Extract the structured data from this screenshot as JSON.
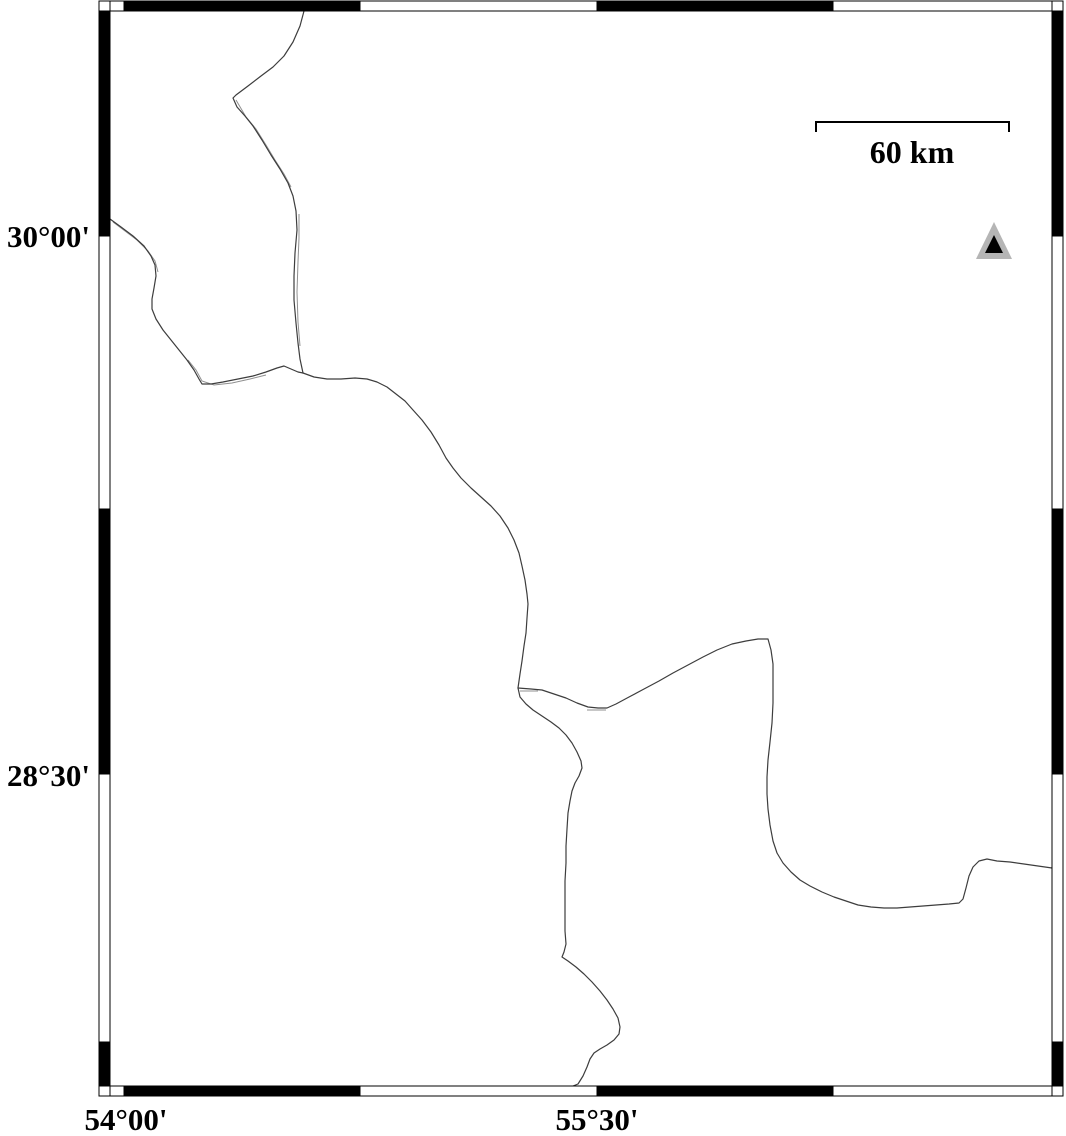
{
  "figure": {
    "width": 1066,
    "height": 1136,
    "background": "#ffffff"
  },
  "colors": {
    "frame_black": "#000000",
    "frame_white": "#ffffff",
    "frame_outline": "#000000",
    "boundary_line": "#3d3d3d",
    "boundary_ghost": "#8f8f8f",
    "marker_outer": "#b5b5b5",
    "marker_inner": "#000000",
    "text": "#000000"
  },
  "frame": {
    "outer": {
      "left": 99,
      "top": 1,
      "right": 1063,
      "bottom": 1096
    },
    "inner": {
      "left": 110,
      "top": 11,
      "right": 1052,
      "bottom": 1086
    },
    "x_boundaries": [
      124,
      360,
      597,
      833
    ],
    "y_boundaries": [
      236,
      509,
      774,
      1042
    ],
    "x_black_segments": [
      [
        124,
        360
      ],
      [
        597,
        833
      ]
    ],
    "y_black_segments": [
      [
        11,
        236
      ],
      [
        509,
        774
      ],
      [
        1042,
        1086
      ]
    ]
  },
  "axes": {
    "left_labels": [
      {
        "text": "30°00'",
        "y": 236,
        "right_x": 90
      },
      {
        "text": "28°30'",
        "y": 775,
        "right_x": 90
      }
    ],
    "bottom_labels": [
      {
        "text": "54°00'",
        "x": 126,
        "y": 1104
      },
      {
        "text": "55°30'",
        "x": 597,
        "y": 1104
      }
    ]
  },
  "scale_bar": {
    "label": "60 km",
    "x1": 816,
    "x2": 1009,
    "y": 122,
    "tick_drop": 10,
    "label_x": 912,
    "label_y": 136
  },
  "marker": {
    "type": "triangle",
    "outer_points": "994,222 976,259 1012,259",
    "inner_points": "994,235 985,253 1003,253"
  },
  "boundaries": {
    "stroke_width": 1.2,
    "lines": {
      "north": [
        [
          304,
          11
        ],
        [
          300,
          26
        ],
        [
          293,
          42
        ],
        [
          284,
          56
        ],
        [
          273,
          67
        ],
        [
          261,
          76
        ],
        [
          248,
          86
        ],
        [
          236,
          95
        ],
        [
          233,
          98
        ],
        [
          237,
          107
        ],
        [
          245,
          116
        ],
        [
          253,
          126
        ],
        [
          262,
          140
        ],
        [
          271,
          155
        ],
        [
          280,
          169
        ],
        [
          288,
          183
        ],
        [
          293,
          196
        ],
        [
          296,
          211
        ],
        [
          297,
          230
        ],
        [
          295,
          253
        ],
        [
          294,
          276
        ],
        [
          294,
          300
        ],
        [
          296,
          323
        ],
        [
          298,
          343
        ],
        [
          300,
          359
        ],
        [
          303,
          373
        ]
      ],
      "west": [
        [
          110,
          219
        ],
        [
          121,
          227
        ],
        [
          133,
          236
        ],
        [
          144,
          246
        ],
        [
          151,
          256
        ],
        [
          155,
          265
        ],
        [
          156,
          276
        ],
        [
          154,
          288
        ],
        [
          152,
          299
        ],
        [
          152,
          309
        ],
        [
          156,
          319
        ],
        [
          163,
          330
        ],
        [
          171,
          340
        ],
        [
          179,
          350
        ],
        [
          187,
          360
        ],
        [
          194,
          370
        ],
        [
          199,
          379
        ],
        [
          202,
          384
        ],
        [
          211,
          384
        ],
        [
          223,
          382
        ],
        [
          238,
          379
        ],
        [
          253,
          376
        ],
        [
          266,
          372
        ],
        [
          277,
          368
        ],
        [
          284,
          366
        ],
        [
          291,
          369
        ],
        [
          298,
          372
        ],
        [
          303,
          373
        ]
      ],
      "central": [
        [
          303,
          373
        ],
        [
          314,
          377
        ],
        [
          327,
          379
        ],
        [
          341,
          379
        ],
        [
          355,
          378
        ],
        [
          367,
          379
        ],
        [
          377,
          382
        ],
        [
          387,
          387
        ],
        [
          396,
          394
        ],
        [
          405,
          401
        ],
        [
          413,
          410
        ],
        [
          422,
          420
        ],
        [
          431,
          432
        ],
        [
          439,
          445
        ],
        [
          446,
          458
        ],
        [
          453,
          468
        ],
        [
          461,
          478
        ],
        [
          471,
          488
        ],
        [
          481,
          497
        ],
        [
          491,
          506
        ],
        [
          500,
          516
        ],
        [
          508,
          528
        ],
        [
          514,
          540
        ],
        [
          519,
          553
        ],
        [
          522,
          566
        ],
        [
          525,
          580
        ],
        [
          527,
          594
        ],
        [
          528,
          604
        ],
        [
          527,
          618
        ],
        [
          526,
          633
        ],
        [
          524,
          646
        ],
        [
          522,
          661
        ],
        [
          520,
          674
        ],
        [
          518,
          688
        ]
      ],
      "east": [
        [
          518,
          688
        ],
        [
          531,
          689
        ],
        [
          542,
          690
        ],
        [
          554,
          694
        ],
        [
          566,
          698
        ],
        [
          577,
          703
        ],
        [
          588,
          707
        ],
        [
          598,
          708
        ],
        [
          607,
          708
        ],
        [
          616,
          704
        ],
        [
          629,
          697
        ],
        [
          644,
          689
        ],
        [
          659,
          681
        ],
        [
          673,
          673
        ],
        [
          688,
          665
        ],
        [
          703,
          657
        ],
        [
          717,
          650
        ],
        [
          732,
          644
        ],
        [
          746,
          641
        ],
        [
          758,
          639
        ],
        [
          768,
          639
        ],
        [
          771,
          650
        ],
        [
          773,
          664
        ],
        [
          773,
          683
        ],
        [
          773,
          703
        ],
        [
          772,
          723
        ],
        [
          770,
          742
        ],
        [
          768,
          760
        ],
        [
          767,
          777
        ],
        [
          767,
          794
        ],
        [
          768,
          809
        ],
        [
          770,
          825
        ],
        [
          773,
          841
        ],
        [
          777,
          853
        ],
        [
          783,
          863
        ],
        [
          791,
          872
        ],
        [
          800,
          880
        ],
        [
          810,
          886
        ],
        [
          822,
          892
        ],
        [
          834,
          897
        ],
        [
          846,
          901
        ],
        [
          858,
          905
        ],
        [
          871,
          907
        ],
        [
          884,
          908
        ],
        [
          897,
          908
        ],
        [
          910,
          907
        ],
        [
          923,
          906
        ],
        [
          936,
          905
        ],
        [
          949,
          904
        ],
        [
          959,
          903
        ],
        [
          963,
          899
        ],
        [
          966,
          888
        ],
        [
          969,
          876
        ],
        [
          973,
          867
        ],
        [
          979,
          861
        ],
        [
          987,
          859
        ],
        [
          997,
          861
        ],
        [
          1010,
          862
        ],
        [
          1024,
          864
        ],
        [
          1038,
          866
        ],
        [
          1052,
          868
        ]
      ],
      "south": [
        [
          518,
          688
        ],
        [
          520,
          697
        ],
        [
          526,
          704
        ],
        [
          533,
          710
        ],
        [
          542,
          716
        ],
        [
          551,
          722
        ],
        [
          559,
          728
        ],
        [
          566,
          735
        ],
        [
          572,
          743
        ],
        [
          577,
          752
        ],
        [
          581,
          761
        ],
        [
          582,
          768
        ],
        [
          579,
          776
        ],
        [
          575,
          783
        ],
        [
          572,
          791
        ],
        [
          570,
          801
        ],
        [
          568,
          813
        ],
        [
          567,
          829
        ],
        [
          566,
          846
        ],
        [
          566,
          863
        ],
        [
          565,
          881
        ],
        [
          565,
          899
        ],
        [
          565,
          916
        ],
        [
          565,
          931
        ],
        [
          566,
          944
        ],
        [
          564,
          952
        ],
        [
          562,
          957
        ],
        [
          568,
          961
        ],
        [
          576,
          967
        ],
        [
          584,
          974
        ],
        [
          592,
          982
        ],
        [
          600,
          991
        ],
        [
          607,
          1000
        ],
        [
          613,
          1009
        ],
        [
          618,
          1018
        ],
        [
          620,
          1027
        ],
        [
          619,
          1034
        ],
        [
          614,
          1040
        ],
        [
          607,
          1045
        ],
        [
          600,
          1049
        ],
        [
          594,
          1053
        ],
        [
          590,
          1059
        ],
        [
          587,
          1067
        ],
        [
          583,
          1076
        ],
        [
          578,
          1084
        ],
        [
          573,
          1086
        ]
      ]
    },
    "ghost_width": 1,
    "ghosts": [
      [
        [
          236,
          100
        ],
        [
          246,
          117
        ],
        [
          256,
          129
        ],
        [
          266,
          145
        ],
        [
          275,
          160
        ],
        [
          284,
          174
        ],
        [
          291,
          187
        ]
      ],
      [
        [
          299,
          214
        ],
        [
          299,
          238
        ],
        [
          298,
          262
        ],
        [
          297,
          292
        ],
        [
          298,
          322
        ],
        [
          300,
          346
        ]
      ],
      [
        [
          113,
          222
        ],
        [
          125,
          231
        ],
        [
          137,
          240
        ],
        [
          148,
          251
        ],
        [
          155,
          261
        ],
        [
          158,
          272
        ]
      ],
      [
        [
          188,
          360
        ],
        [
          196,
          370
        ],
        [
          202,
          381
        ],
        [
          214,
          385
        ],
        [
          232,
          383
        ],
        [
          250,
          379
        ],
        [
          266,
          375
        ]
      ],
      [
        [
          520,
          691
        ],
        [
          538,
          691
        ]
      ],
      [
        [
          587,
          710
        ],
        [
          606,
          710
        ]
      ]
    ]
  }
}
